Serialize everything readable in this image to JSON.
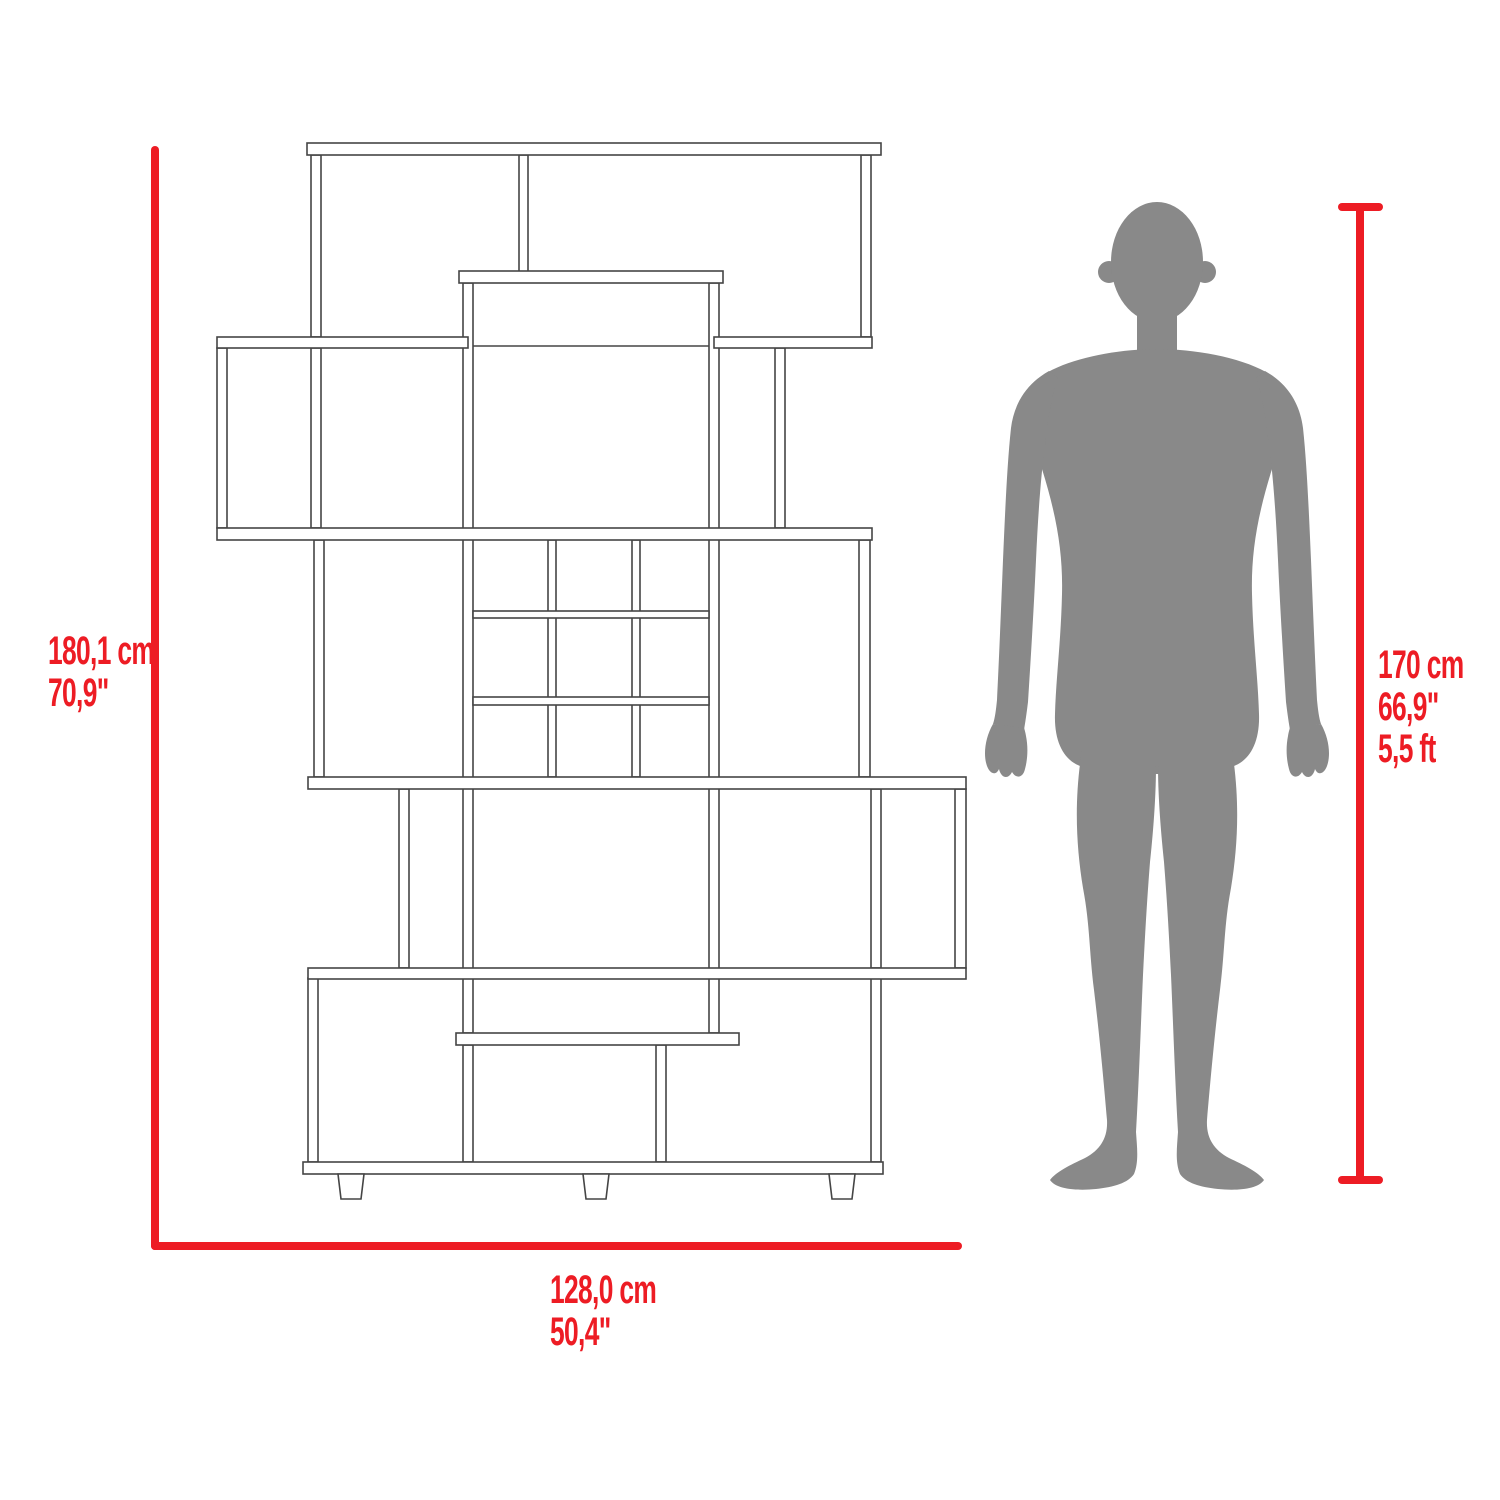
{
  "colors": {
    "dimension_red": "#ed1c24",
    "silhouette_gray": "#898989",
    "drawing_line": "#454545",
    "background": "#ffffff"
  },
  "dimensions": {
    "height": {
      "cm": "180,1 cm",
      "inches": "70,9\""
    },
    "width": {
      "cm": "128,0 cm",
      "inches": "50,4\""
    },
    "person": {
      "cm": "170 cm",
      "inches": "66,9\"",
      "feet": "5,5 ft"
    }
  }
}
